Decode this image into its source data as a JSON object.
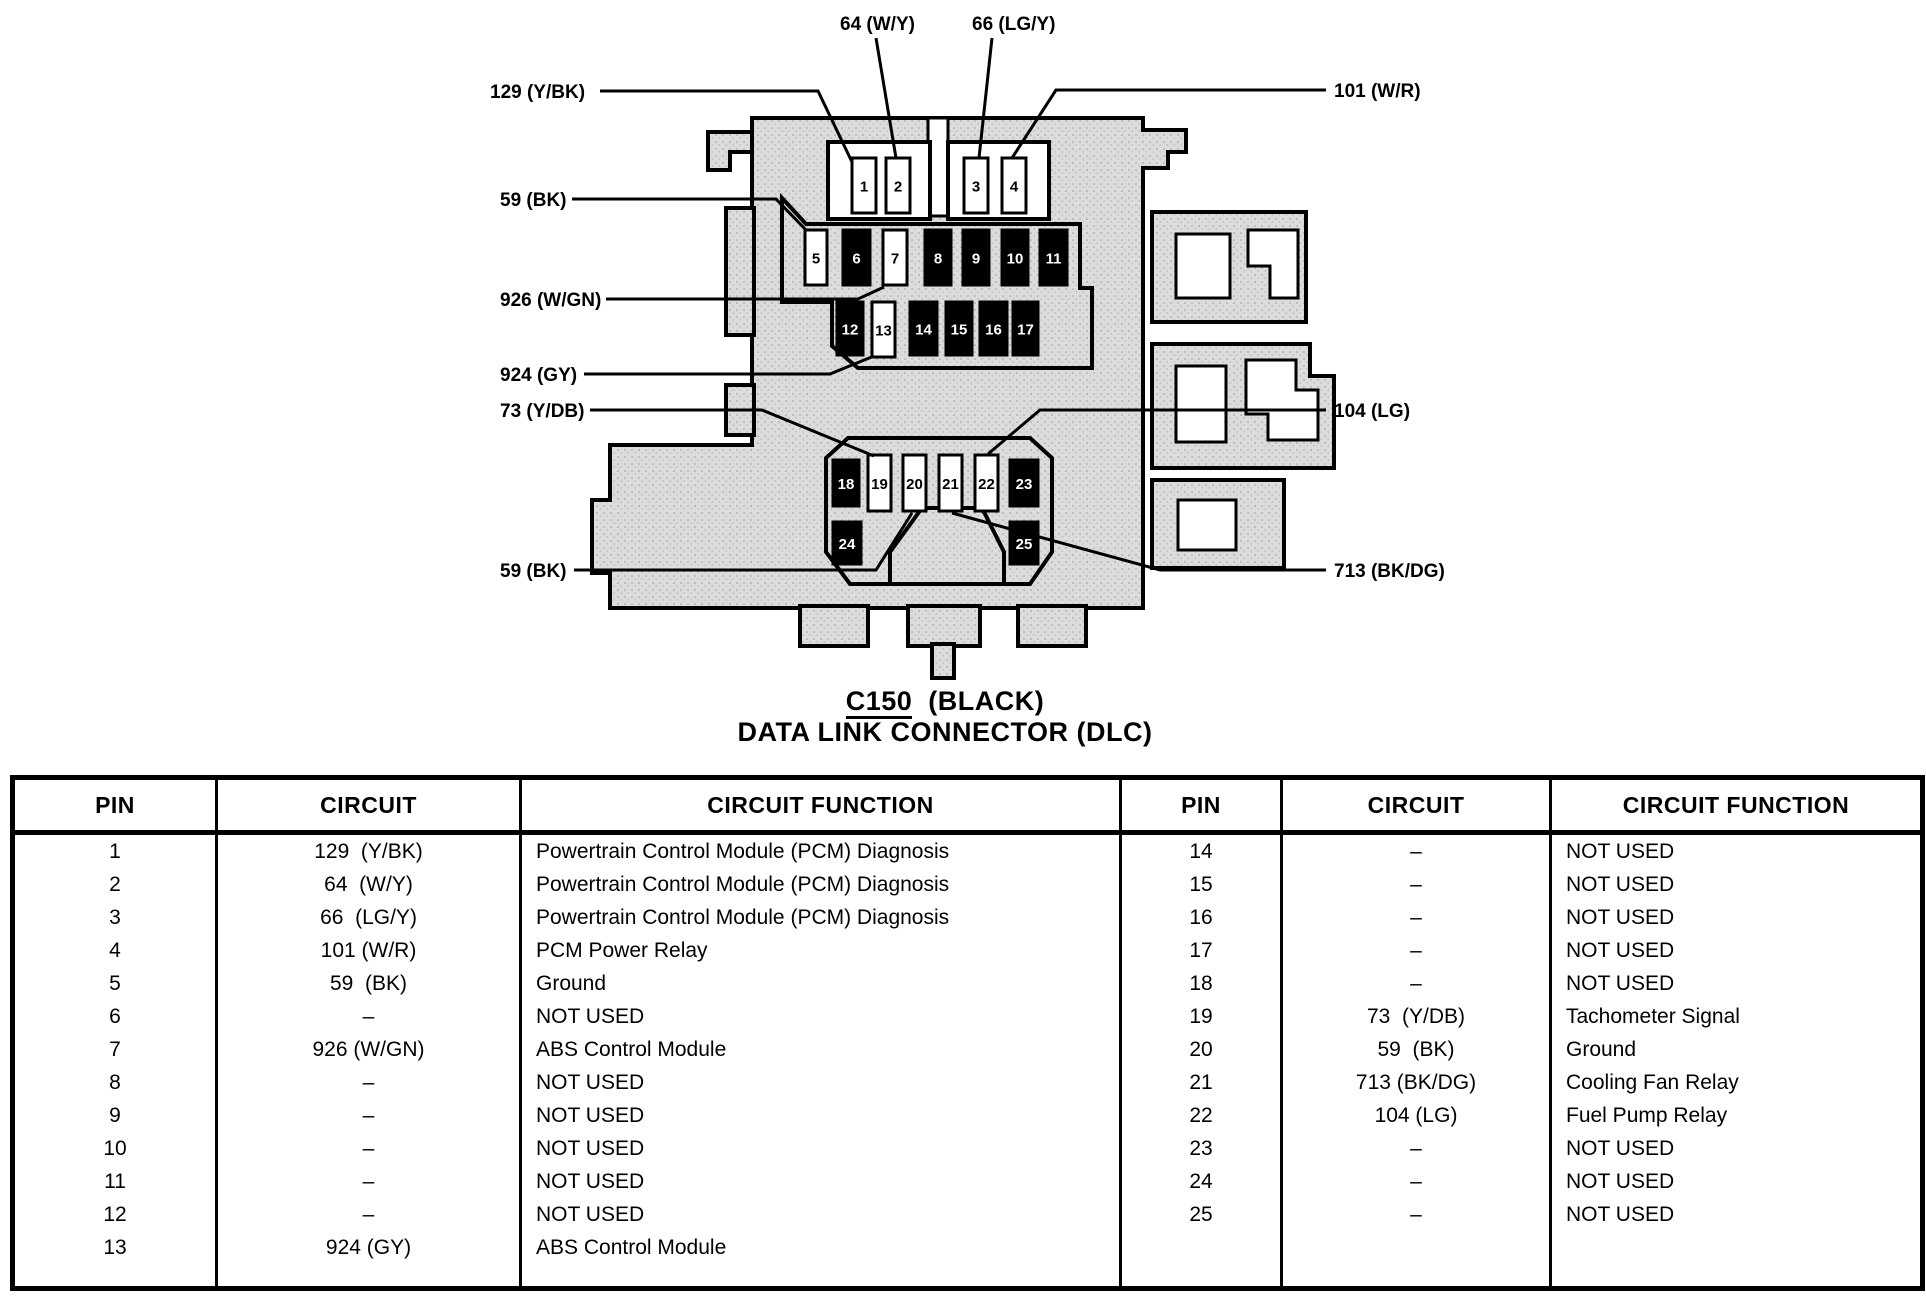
{
  "colors": {
    "ink": "#000000",
    "paper": "#ffffff",
    "connector_fill": "#dcdcdc"
  },
  "diagram": {
    "caption": {
      "code": "C150",
      "color": "(BLACK)",
      "title": "DATA LINK CONNECTOR (DLC)"
    },
    "labels": [
      {
        "id": "wire-64",
        "text": "64 (W/Y)"
      },
      {
        "id": "wire-66",
        "text": "66 (LG/Y)"
      },
      {
        "id": "wire-129",
        "text": "129 (Y/BK)"
      },
      {
        "id": "wire-101",
        "text": "101 (W/R)"
      },
      {
        "id": "wire-59-top",
        "text": "59 (BK)"
      },
      {
        "id": "wire-926",
        "text": "926 (W/GN)"
      },
      {
        "id": "wire-924",
        "text": "924 (GY)"
      },
      {
        "id": "wire-73",
        "text": "73 (Y/DB)"
      },
      {
        "id": "wire-104",
        "text": "104 (LG)"
      },
      {
        "id": "wire-59-bottom",
        "text": "59 (BK)"
      },
      {
        "id": "wire-713",
        "text": "713 (BK/DG)"
      }
    ],
    "pins": [
      {
        "n": 1,
        "filled": false
      },
      {
        "n": 2,
        "filled": false
      },
      {
        "n": 3,
        "filled": false
      },
      {
        "n": 4,
        "filled": false
      },
      {
        "n": 5,
        "filled": false
      },
      {
        "n": 6,
        "filled": true
      },
      {
        "n": 7,
        "filled": false
      },
      {
        "n": 8,
        "filled": true
      },
      {
        "n": 9,
        "filled": true
      },
      {
        "n": 10,
        "filled": true
      },
      {
        "n": 11,
        "filled": true
      },
      {
        "n": 12,
        "filled": true
      },
      {
        "n": 13,
        "filled": false
      },
      {
        "n": 14,
        "filled": true
      },
      {
        "n": 15,
        "filled": true
      },
      {
        "n": 16,
        "filled": true
      },
      {
        "n": 17,
        "filled": true
      },
      {
        "n": 18,
        "filled": true
      },
      {
        "n": 19,
        "filled": false
      },
      {
        "n": 20,
        "filled": false
      },
      {
        "n": 21,
        "filled": false
      },
      {
        "n": 22,
        "filled": false
      },
      {
        "n": 23,
        "filled": true
      },
      {
        "n": 24,
        "filled": true
      },
      {
        "n": 25,
        "filled": true
      }
    ]
  },
  "table": {
    "headers": [
      "PIN",
      "CIRCUIT",
      "CIRCUIT FUNCTION"
    ],
    "left_rows": [
      [
        "1",
        "129  (Y/BK)",
        "Powertrain Control Module (PCM) Diagnosis"
      ],
      [
        "2",
        "64  (W/Y)",
        "Powertrain Control Module (PCM) Diagnosis"
      ],
      [
        "3",
        "66  (LG/Y)",
        "Powertrain Control Module (PCM) Diagnosis"
      ],
      [
        "4",
        "101 (W/R)",
        "PCM Power Relay"
      ],
      [
        "5",
        "59  (BK)",
        "Ground"
      ],
      [
        "6",
        "–",
        "NOT USED"
      ],
      [
        "7",
        "926 (W/GN)",
        "ABS Control Module"
      ],
      [
        "8",
        "–",
        "NOT USED"
      ],
      [
        "9",
        "–",
        "NOT USED"
      ],
      [
        "10",
        "–",
        "NOT USED"
      ],
      [
        "11",
        "–",
        "NOT USED"
      ],
      [
        "12",
        "–",
        "NOT USED"
      ],
      [
        "13",
        "924 (GY)",
        "ABS Control Module"
      ]
    ],
    "right_rows": [
      [
        "14",
        "–",
        "NOT USED"
      ],
      [
        "15",
        "–",
        "NOT USED"
      ],
      [
        "16",
        "–",
        "NOT USED"
      ],
      [
        "17",
        "–",
        "NOT USED"
      ],
      [
        "18",
        "–",
        "NOT USED"
      ],
      [
        "19",
        "73  (Y/DB)",
        "Tachometer Signal"
      ],
      [
        "20",
        "59  (BK)",
        "Ground"
      ],
      [
        "21",
        "713 (BK/DG)",
        "Cooling Fan Relay"
      ],
      [
        "22",
        "104 (LG)",
        "Fuel Pump Relay"
      ],
      [
        "23",
        "–",
        "NOT USED"
      ],
      [
        "24",
        "–",
        "NOT USED"
      ],
      [
        "25",
        "–",
        "NOT USED"
      ]
    ]
  }
}
